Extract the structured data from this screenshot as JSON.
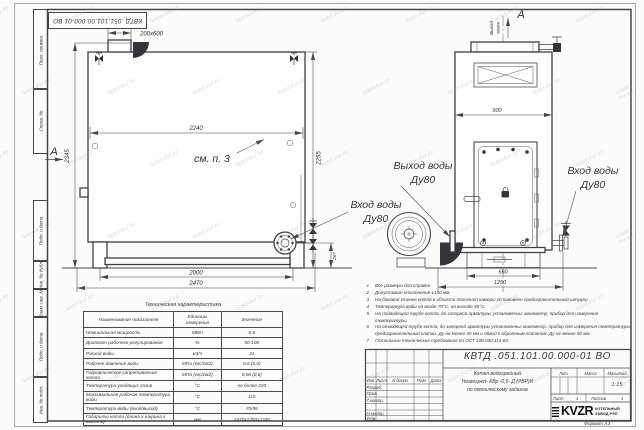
{
  "sheet": {
    "stamp_doc_number": "КВТД .051.101.00.000-01 ВО",
    "format_label": "Формат А3",
    "watermark_text": "kotel-kvr.kz"
  },
  "margin_labels": [
    "Перв. примен.",
    "Справ. №",
    "Подп. и дата",
    "Инв. № дубл.",
    "Взам. инв. №",
    "Подп. и дата",
    "Инв. № подл."
  ],
  "drawing": {
    "labels": {
      "chimney_dim": "200x600",
      "top_width": "2240",
      "see_note": "см. п. 3",
      "left_height": "2345",
      "right_height": "2255",
      "legs_width": "2000",
      "total_width": "2470",
      "flange_height": "267",
      "section_a": "А",
      "inlet_water": "Вход воды",
      "outlet_water": "Выход воды",
      "dn80": "Ду80",
      "gas_out_word1": "Выход",
      "gas_out_word2": "газов",
      "front_width": "900",
      "base_width": "660",
      "base_total_width": "1250"
    }
  },
  "notes": {
    "items": [
      {
        "num": "1",
        "text": "Все размеры для справок"
      },
      {
        "num": "2",
        "text": "Допустимое отклонение ±100 мм."
      },
      {
        "num": "3",
        "text": "На боковой стенке котла в области топочной камеры установлен предохранительный штуцер"
      },
      {
        "num": "4",
        "text": "Температура воды на входе 70°С, на выходе 95°С."
      },
      {
        "num": "5",
        "text": "На подводящей трубе котла, до запорной арматуры установлены: манометр, прибор для измерения температуры."
      },
      {
        "num": "6",
        "text": "На отводящей трубе котла, до запорной арматуры установлены: манометр, прибор для измерения температуры, предохранительный клапан. Ду не менее 40 мм и обвод с обратным клапаном. Ду не менее 50 мм."
      },
      {
        "num": "7",
        "text": "Остальные технические требования по ОСТ 108.030.113-84"
      }
    ]
  },
  "spec_table": {
    "title": "Техническая характеристика",
    "headers": [
      "Наименование показателя",
      "Единицы измерения",
      "Значение"
    ],
    "rows": [
      [
        "Номинальная мощность",
        "МВт",
        "0,6"
      ],
      [
        "Диапазон рабочего регулирования",
        "%",
        "50-100"
      ],
      [
        "Расход воды",
        "м3/ч",
        "21"
      ],
      [
        "Рабочее давление воды",
        "МПа (кгс/см2)",
        "0,6 (6,0)"
      ],
      [
        "Гидравлическое сопротивление котла",
        "МПа (кгс/см2)",
        "0,06 (0,6)"
      ],
      [
        "Температура уходящих газов",
        "°С",
        "не более 220"
      ],
      [
        "Максимальная рабочая температура воды",
        "°С",
        "115"
      ],
      [
        "Температура воды (вход/выход)",
        "°С",
        "70/95"
      ],
      [
        "Габариты котла (длина х ширина х высота)",
        "мм",
        "2470х1250х2345"
      ]
    ]
  },
  "title_block": {
    "doc_number": "КВТД .051.101.00.000-01 ВО",
    "rev_cols": [
      "Изм",
      "Лист",
      "N докум.",
      "Подп",
      "Дата"
    ],
    "sign_labels": [
      "Разраб.",
      "Пров.",
      "Т.контр.",
      "Н.контр.",
      "Утв."
    ],
    "product_lines": [
      "Котел водогрейный",
      "Heatexpert- КВр -0,6- Д (РВР)И",
      "по техническому задание"
    ],
    "lit_label": "Лит.",
    "mass_label": "Масса",
    "scale_label": "Масштаб",
    "scale_value": "1:15",
    "sheet_label": "Лист",
    "sheet_value": "1",
    "sheets_label": "Листов",
    "sheets_value": "1",
    "logo_text": "KVZR",
    "company_line1": "КОТЕЛЬНЫЙ",
    "company_line2": "ЗАВОД РЭП"
  }
}
